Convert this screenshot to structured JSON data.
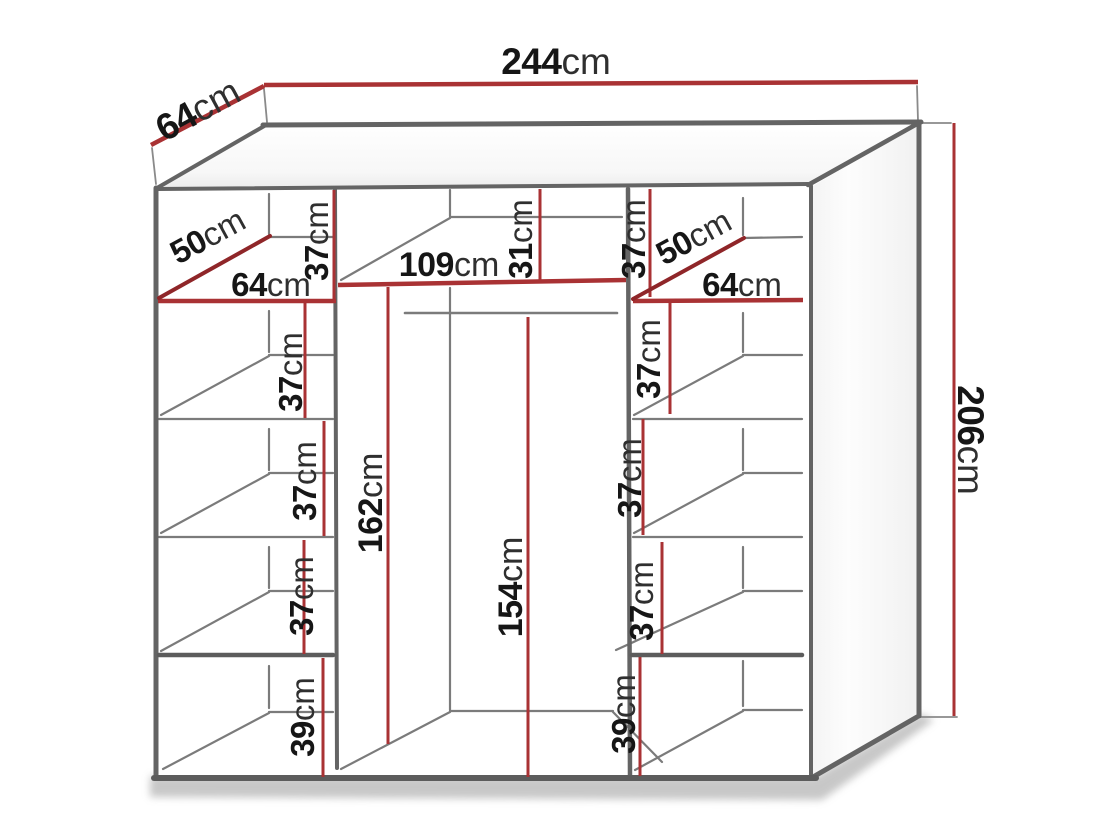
{
  "diagram_type": "wardrobe-dimension-drawing",
  "unit": "cm",
  "colors": {
    "dimension_red": "#a93234",
    "dimension_red_dark": "#8f2629",
    "outline_gray": "#646464",
    "outline_dark": "#5c5c5c",
    "interior_gray": "#7b7b7b",
    "extension_gray": "#8a8a8a",
    "number_black": "#161616",
    "unit_gray": "#2f2f2f"
  },
  "dimensions": {
    "total_width": {
      "value": "244",
      "unit": "cm"
    },
    "depth": {
      "value": "64",
      "unit": "cm"
    },
    "total_height": {
      "value": "206",
      "unit": "cm"
    },
    "middle_width": {
      "value": "109",
      "unit": "cm"
    },
    "middle_top_gap": {
      "value": "31",
      "unit": "cm"
    },
    "middle_interior_height": {
      "value": "162",
      "unit": "cm"
    },
    "rail_height": {
      "value": "154",
      "unit": "cm"
    },
    "left_column": {
      "corner_shelf_depth": {
        "value": "50",
        "unit": "cm"
      },
      "width": {
        "value": "64",
        "unit": "cm"
      },
      "gap1": {
        "value": "37",
        "unit": "cm"
      },
      "gap2": {
        "value": "37",
        "unit": "cm"
      },
      "gap3": {
        "value": "37",
        "unit": "cm"
      },
      "gap4": {
        "value": "37",
        "unit": "cm"
      },
      "bottom_gap": {
        "value": "39",
        "unit": "cm"
      }
    },
    "right_column": {
      "corner_shelf_depth": {
        "value": "50",
        "unit": "cm"
      },
      "width": {
        "value": "64",
        "unit": "cm"
      },
      "gap1": {
        "value": "37",
        "unit": "cm"
      },
      "gap2": {
        "value": "37",
        "unit": "cm"
      },
      "gap3": {
        "value": "37",
        "unit": "cm"
      },
      "gap4": {
        "value": "37",
        "unit": "cm"
      },
      "bottom_gap": {
        "value": "39",
        "unit": "cm"
      }
    }
  }
}
